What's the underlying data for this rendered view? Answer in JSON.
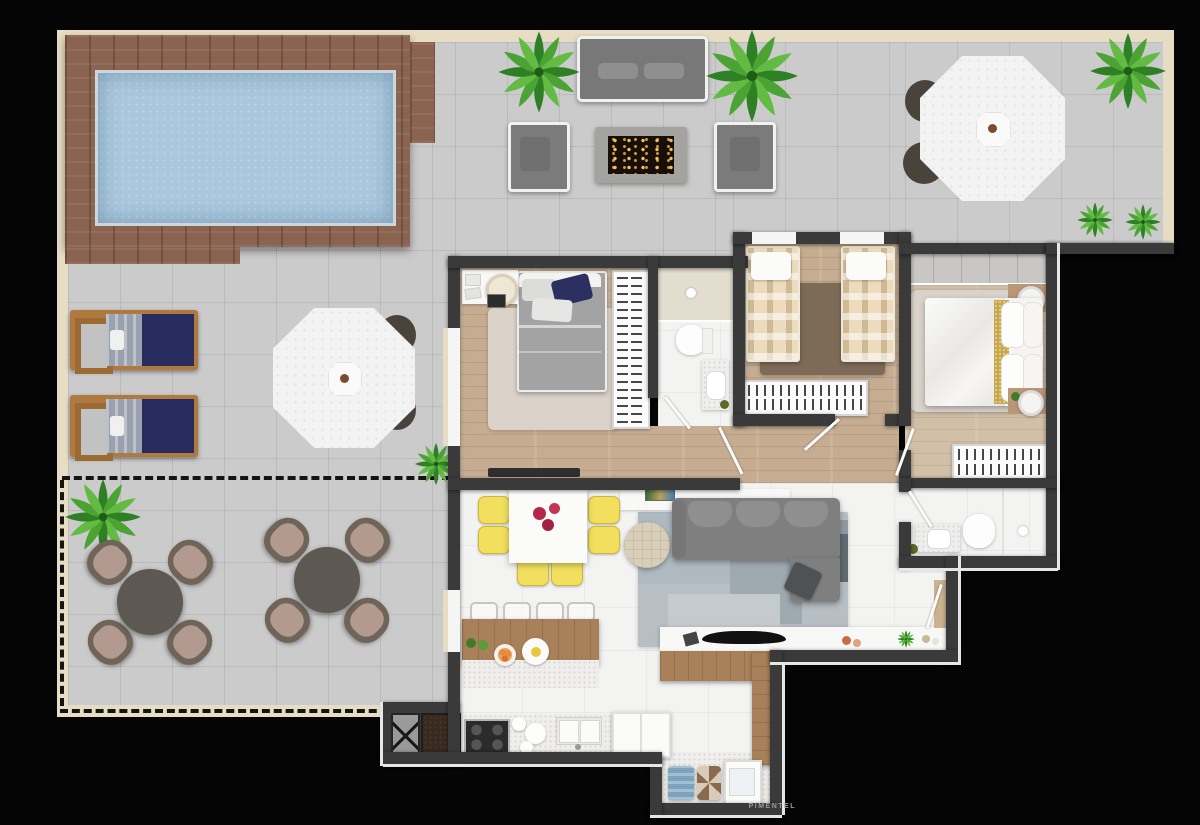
{
  "watermark": "PIMENTEL",
  "scene": {
    "type": "apartment-penthouse-floor-plan-top-view",
    "background": "#050505",
    "boundary_style": "dashed line marks private terrace limit"
  },
  "palette": {
    "outdoor_tile": "#cbcbcb",
    "indoor_tile": "#f3f3f1",
    "bedroom_wood_floor": "#c6ad92",
    "deck_wood": "#8a6450",
    "pool_water": "#a9c7dd",
    "wall": "#3a3a3a",
    "cream_border": "#e7dcc4",
    "plant_green": "#3f9b2f",
    "sofa_gray": "#7f7f7f",
    "dining_chair_yellow": "#f2df5e",
    "lounger_navy": "#272b5e",
    "living_rug_blue_gray": "#b7bec4",
    "terrace_chair_brown": "#6e6457",
    "terrace_chair_cushion": "#b39a90",
    "twin_bed_plaid": "#ecdcbd",
    "gold_bed_runner": "#c9a84c"
  },
  "outdoor": {
    "pool_area": {
      "features": [
        "swimming-pool",
        "wood-deck"
      ]
    },
    "lounge": {
      "furniture": [
        "outdoor-sofa",
        "armchair",
        "armchair",
        "fire-pit-coffee-table"
      ],
      "plants": 2
    },
    "northeast_corner": {
      "furniture": [
        "white-parasol-table",
        "chair",
        "chair"
      ],
      "plants": 3
    },
    "west_terrace": {
      "furniture": [
        "sun-lounger",
        "sun-lounger",
        "white-parasol-table",
        "chair",
        "chair"
      ],
      "lounger_count": 2
    },
    "private_terrace": {
      "boundary": "dashed",
      "furniture": [
        "round-table-with-4-chairs",
        "round-table-with-4-chairs"
      ],
      "plants": 2
    }
  },
  "rooms": [
    {
      "id": "bedroom-1",
      "floor": "wood",
      "furniture": [
        "double-bed",
        "area-rug",
        "desk",
        "desk-chair",
        "hanger-wardrobe",
        "tv-panel"
      ]
    },
    {
      "id": "bathroom-1",
      "floor": "white",
      "furniture": [
        "shower",
        "toilet",
        "vanity-sink"
      ]
    },
    {
      "id": "bedroom-2-twin",
      "floor": "wood",
      "furniture": [
        "single-bed",
        "single-bed",
        "brown-rug",
        "low-dresser"
      ]
    },
    {
      "id": "master-bedroom",
      "floor": "wood",
      "furniture": [
        "double-bed",
        "area-rug",
        "nightstand-with-lamp",
        "nightstand-with-lamp",
        "built-in-closet",
        "hanger-wardrobe"
      ]
    },
    {
      "id": "master-bathroom",
      "floor": "white",
      "furniture": [
        "vanity-sink",
        "toilet",
        "shower"
      ]
    },
    {
      "id": "living-room",
      "floor": "white-tile",
      "furniture": [
        "corner-sofa",
        "patchwork-rug",
        "round-pouf",
        "sideboard-with-art",
        "media-counter",
        "tv",
        "wood-desk"
      ]
    },
    {
      "id": "dining-area",
      "floor": "white-tile",
      "furniture": [
        "square-white-table-with-flowers",
        "yellow-chair-x6",
        "kitchen-island",
        "bar-stool-x4"
      ]
    },
    {
      "id": "kitchen",
      "floor": "white-tile",
      "furniture": [
        "cooktop-4-burners",
        "double-sink",
        "refrigerator",
        "granite-counter"
      ]
    },
    {
      "id": "laundry",
      "floor": "stone",
      "furniture": [
        "towels",
        "wicker-basket",
        "laundry-tank"
      ]
    },
    {
      "id": "service-core",
      "furniture": [
        "elevator",
        "shaft"
      ]
    }
  ]
}
